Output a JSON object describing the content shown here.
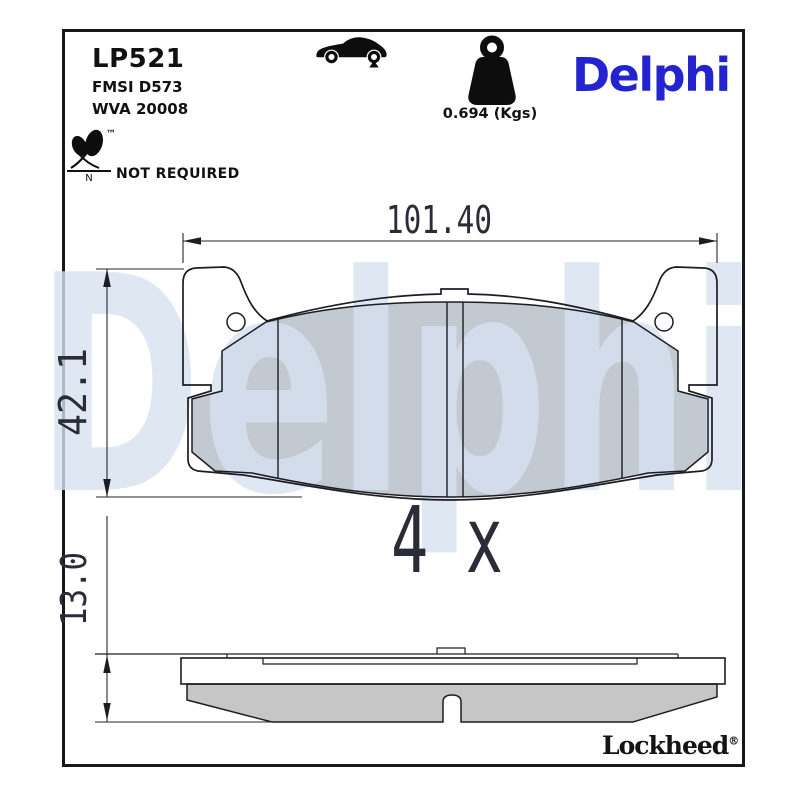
{
  "header": {
    "part_number": "LP521",
    "fmsi_code": "FMSI D573",
    "wva_code": "WVA 20008",
    "brand_logo": "Delphi",
    "weight_label": "0.694 (Kgs)",
    "eco_tm": "™",
    "eco_letter": "N",
    "eco_status": "NOT REQUIRED"
  },
  "drawing": {
    "watermark": "Delphi",
    "dim_width": "101.40",
    "dim_height": "42.1",
    "dim_thickness": "13.0",
    "quantity_note": "4 x"
  },
  "footer": {
    "brand_logo": "Lockheed",
    "registered_mark": "®"
  },
  "icons": {
    "car": "car-rear-axle-icon",
    "weight": "weight-icon",
    "leaf": "leaf-icon"
  },
  "colors": {
    "brand_blue": "#2323cf",
    "watermark_blue": "#d7e1f0",
    "friction_gray": "#c3c9d0",
    "side_friction_gray": "#c6c6c6",
    "line_dark": "#1c1c24",
    "frame_dark": "#17171d"
  }
}
